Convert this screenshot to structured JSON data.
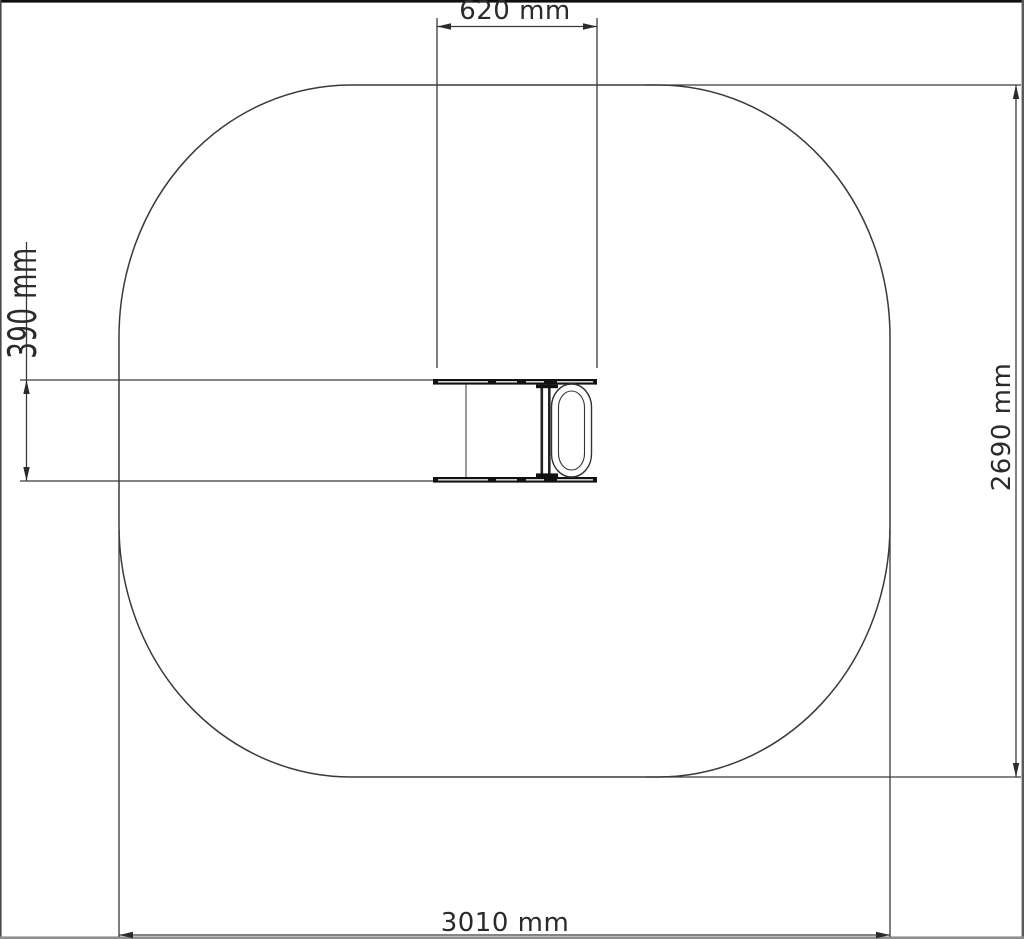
{
  "dimensions": {
    "top_label": "620 mm",
    "left_label": "390 mm",
    "right_label": "2690 mm",
    "bottom_label": "3010 mm"
  },
  "colors": {
    "line": "#3a3a3a",
    "object": "#111111",
    "text": "#2b2b2b"
  }
}
